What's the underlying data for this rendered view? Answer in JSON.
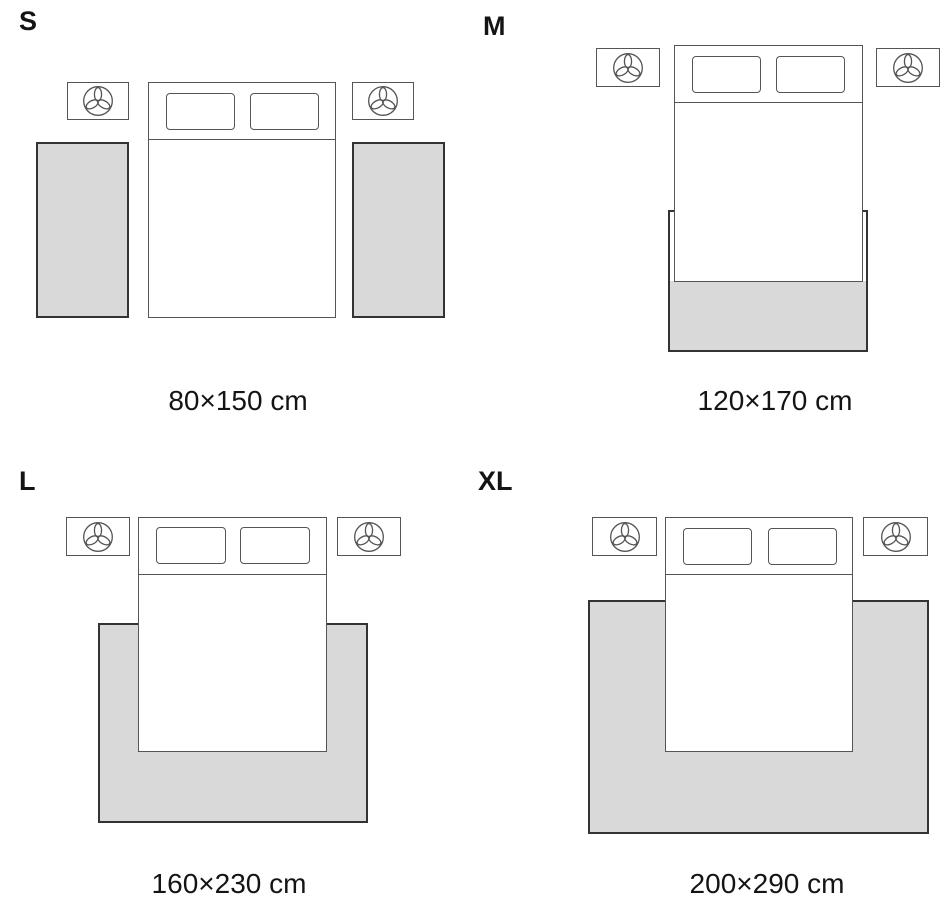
{
  "diagram": {
    "background_color": "#ffffff",
    "rug_fill_color": "#d9d9d9",
    "rug_border_color": "#333333",
    "furniture_line_color": "#555555",
    "text_color": "#141414",
    "nightstand_icon": "plant-trefoil-icon",
    "panels": [
      {
        "size_label": "S",
        "dimensions": "80×150 cm",
        "rug_layout": "two runners beside bed"
      },
      {
        "size_label": "M",
        "dimensions": "120×170 cm",
        "rug_layout": "at foot of bed"
      },
      {
        "size_label": "L",
        "dimensions": "160×230 cm",
        "rug_layout": "under lower two-thirds of bed"
      },
      {
        "size_label": "XL",
        "dimensions": "200×290 cm",
        "rug_layout": "under lower two-thirds of bed, extending wide"
      }
    ]
  }
}
